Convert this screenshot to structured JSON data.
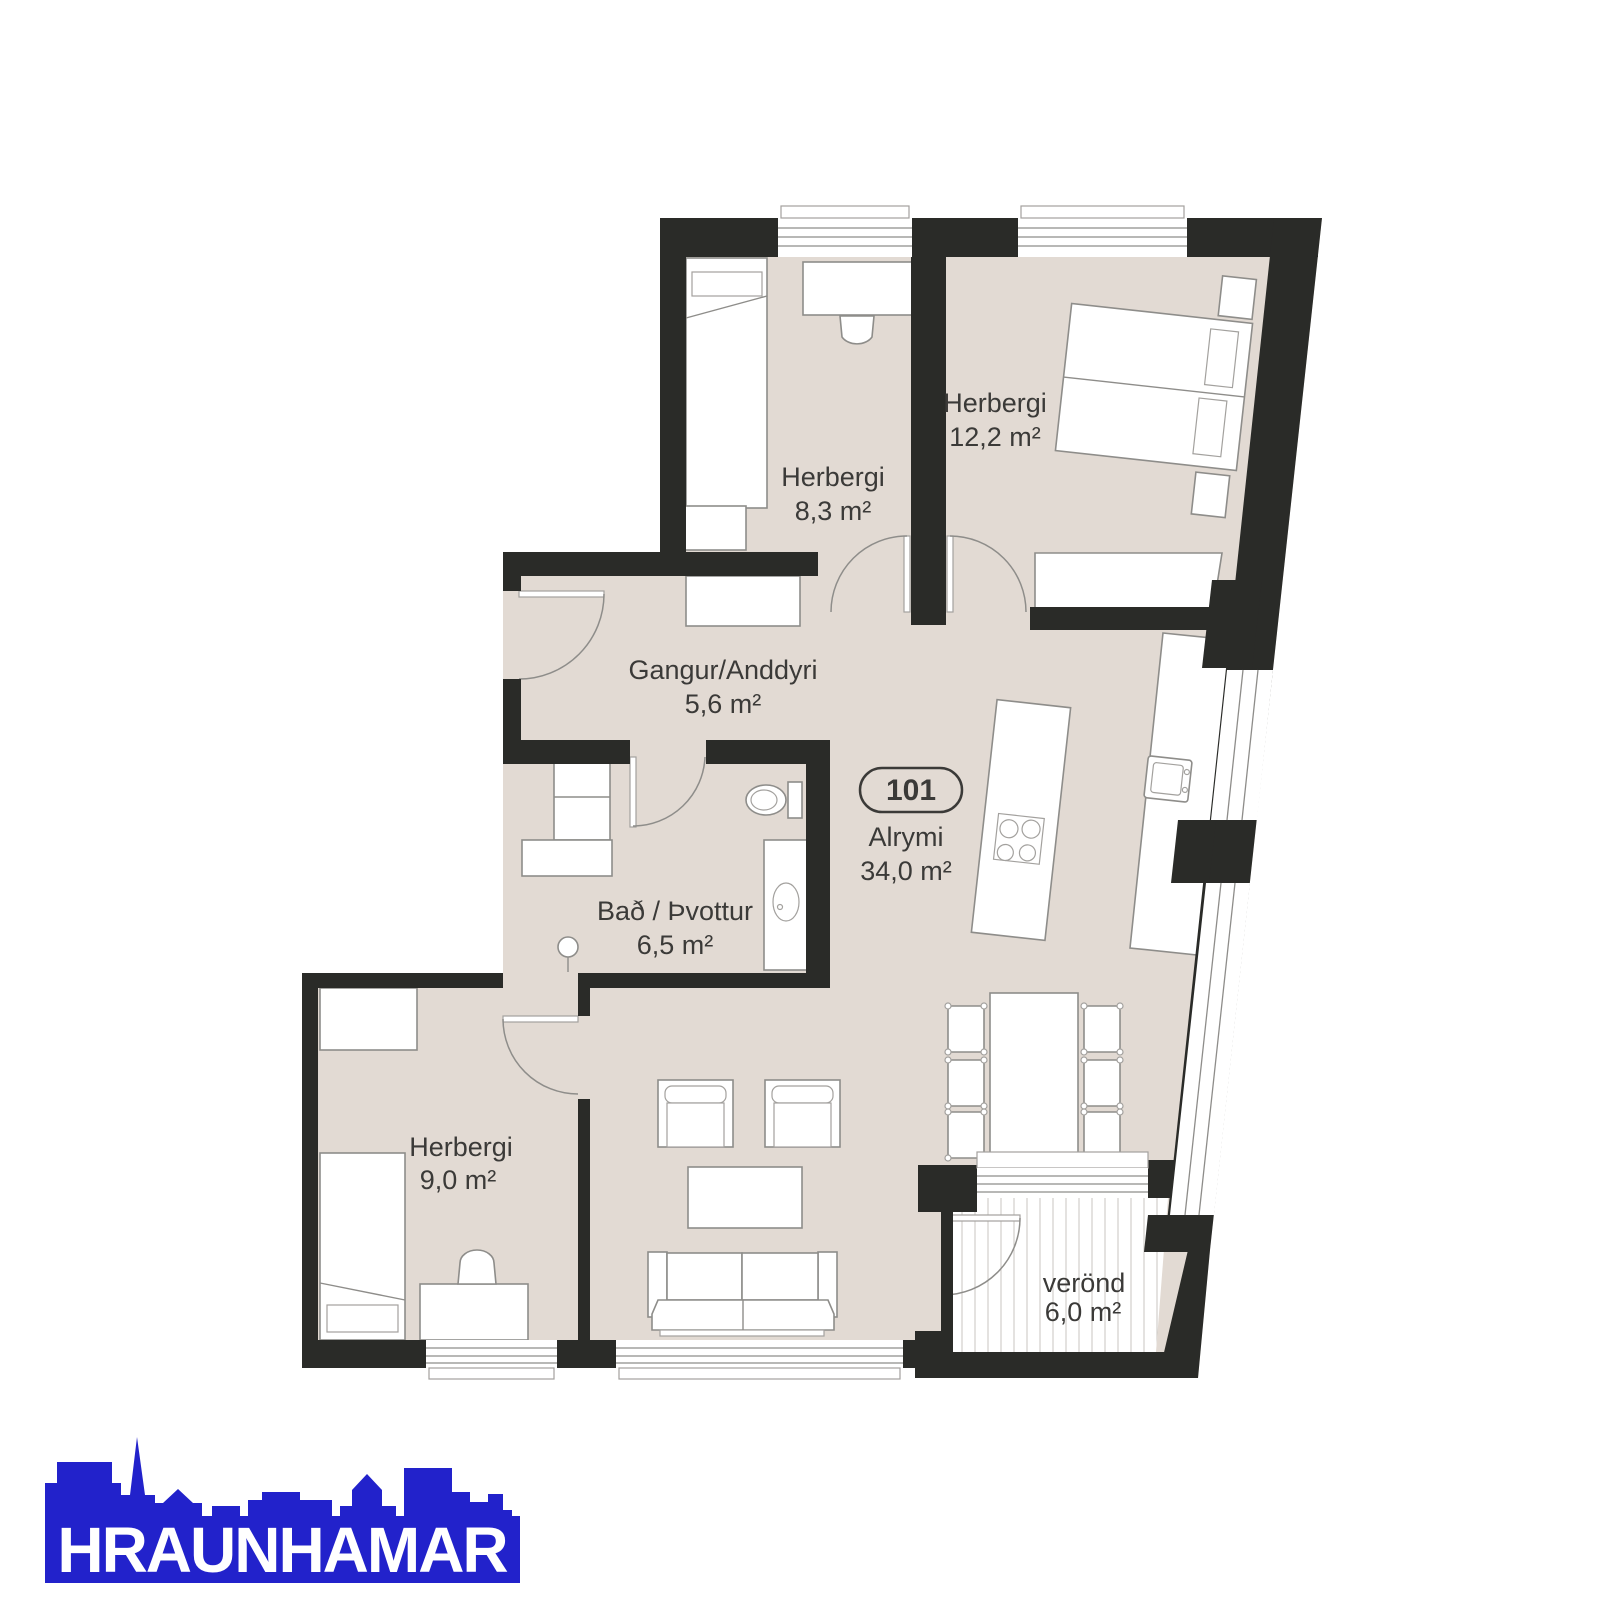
{
  "floorplan": {
    "unit_badge": "101",
    "rooms": [
      {
        "name": "Herbergi",
        "area": "8,3 m²"
      },
      {
        "name": "Herbergi",
        "area": "12,2 m²"
      },
      {
        "name": "Gangur/Anddyri",
        "area": "5,6 m²"
      },
      {
        "name": "Alrymi",
        "area": "34,0 m²"
      },
      {
        "name": "Bað / Þvottur",
        "area": "6,5 m²"
      },
      {
        "name": "Herbergi",
        "area": "9,0 m²"
      },
      {
        "name": "verönd",
        "area": "6,0 m²"
      }
    ],
    "colors": {
      "wall": "#2a2b28",
      "floor": "#e2dad3",
      "furniture_outline": "#8e8d8a",
      "label_text": "#3b3a38"
    }
  },
  "logo": {
    "text": "HRAUNHAMAR",
    "color": "#2222cb"
  }
}
